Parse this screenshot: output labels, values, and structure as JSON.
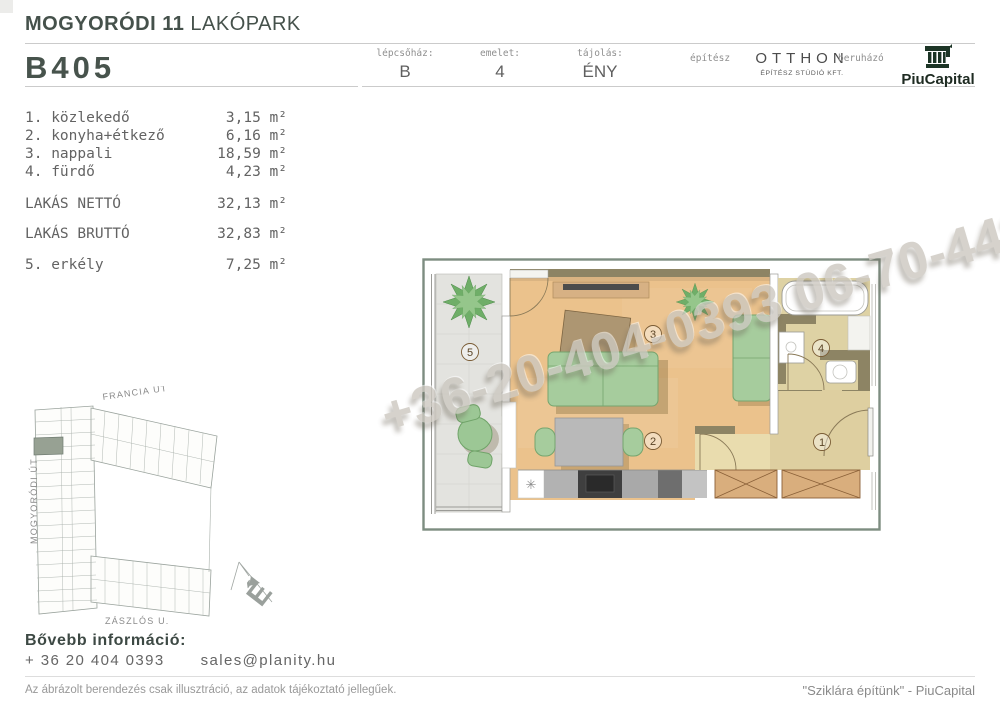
{
  "header": {
    "project_bold": "MOGYORÓDI 11",
    "project_light": " LAKÓPARK",
    "unit_id": "B405",
    "meta": {
      "staircase_label": "lépcsőház:",
      "staircase_value": "B",
      "floor_label": "emelet:",
      "floor_value": "4",
      "orientation_label": "tájolás:",
      "orientation_value": "ÉNY",
      "architect_label": "építész",
      "architect_name": "OTTHON",
      "architect_sub": "ÉPÍTÉSZ STÚDIÓ KFT.",
      "developer_label": "beruházó",
      "developer_name": "PiuCapital"
    }
  },
  "rooms": [
    {
      "label": "1. közlekedő",
      "value": "3,15 m²"
    },
    {
      "label": "2. konyha+étkező",
      "value": "6,16 m²"
    },
    {
      "label": "3. nappali",
      "value": "18,59 m²"
    },
    {
      "label": "4. fürdő",
      "value": "4,23 m²"
    },
    {
      "label": "LAKÁS NETTÓ",
      "value": "32,13 m²"
    },
    {
      "label": "LAKÁS BRUTTÓ",
      "value": "32,83 m²"
    },
    {
      "label": "5. erkély",
      "value": "7,25 m²"
    }
  ],
  "plan": {
    "room_numbers": {
      "balcony": "5",
      "living": "3",
      "dining": "2",
      "bath": "4",
      "hall": "1"
    },
    "sink_symbol": "✳"
  },
  "watermark": {
    "text": "+36-20-404-0393 06-70-442-2"
  },
  "site_map": {
    "street_top": "FRANCIA ÚT",
    "street_left": "MOGYORÓDI ÚT",
    "street_bottom": "ZÁSZLÓS U.",
    "compass_letter": "É"
  },
  "contact": {
    "heading": "Bővebb információ:",
    "phone": "+ 36 20 404 0393",
    "email": "sales@planity.hu"
  },
  "footer": {
    "disclaimer": "Az ábrázolt berendezés csak illusztráció, az adatok tájékoztató jellegűek.",
    "slogan": "\"Sziklára építünk\" - PiuCapital"
  },
  "colors": {
    "accent_dark_green": "#47534c",
    "piucapital_green": "#1c3526",
    "plan_wood": "#ebc28c",
    "plan_khaki": "#ded2a4",
    "furniture_green": "#a6cc9d",
    "highlighted_unit": "#97a193"
  }
}
